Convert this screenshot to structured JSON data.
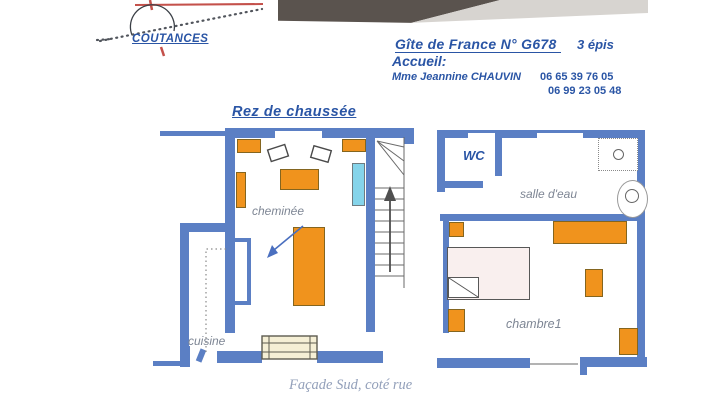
{
  "map_sketch": {
    "city": "COUTANCES"
  },
  "header": {
    "title": "Gîte de France  N° G678",
    "rating": "3 épis",
    "welcome": "Accueil:",
    "host": "Mme Jeannine CHAUVIN",
    "phones": [
      "06 65 39 76 05",
      "06 99 23 05 48"
    ]
  },
  "page": {
    "floor_title": "Rez de chaussée",
    "caption": "Façade Sud, coté rue"
  },
  "ground_floor": {
    "labels": {
      "fireplace": "cheminée",
      "kitchen": "cuisine"
    }
  },
  "first_floor": {
    "labels": {
      "wc": "WC",
      "shower_room": "salle d'eau",
      "bedroom": "chambre1"
    }
  },
  "colors": {
    "wall_blue": "#5b7fc4",
    "furniture_orange": "#f0931d",
    "accent_cyan": "#85d4ea",
    "heading_blue": "#2a55a5",
    "label_gray": "#7e8694",
    "caption_gray_blue": "#93a0ba",
    "map_road_red": "#c4514b"
  }
}
